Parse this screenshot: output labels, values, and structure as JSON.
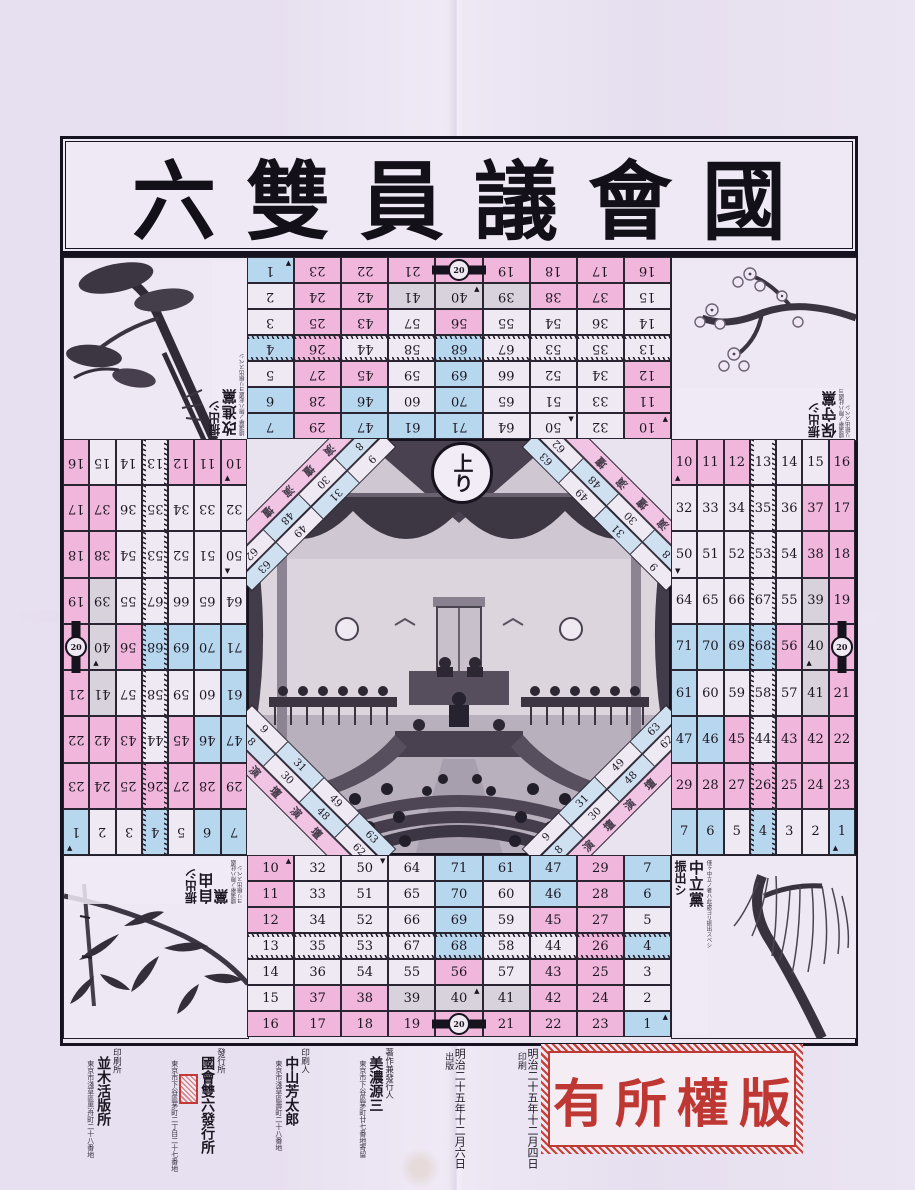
{
  "title": "國會議員雙六",
  "goal_label": "上り",
  "stamp_text": "版權所有",
  "track": {
    "barrier_value": "20",
    "diag_label": "演壇",
    "diag_outer": [
      "9",
      "31",
      "49",
      "63"
    ],
    "diag_inner": [
      "8",
      "30",
      "48",
      "62"
    ],
    "zig_row_index": 3,
    "rows": [
      [
        {
          "n": 16,
          "c": "p"
        },
        {
          "n": 17,
          "c": "p"
        },
        {
          "n": 18,
          "c": "p"
        },
        {
          "n": 19,
          "c": "p"
        },
        {
          "n": 20,
          "c": "p",
          "bar": true
        },
        {
          "n": 21,
          "c": "p"
        },
        {
          "n": 22,
          "c": "p"
        },
        {
          "n": 23,
          "c": "p"
        },
        {
          "n": 1,
          "c": "b",
          "m": "▲"
        }
      ],
      [
        {
          "n": 15,
          "c": "w"
        },
        {
          "n": 37,
          "c": "p"
        },
        {
          "n": 38,
          "c": "p"
        },
        {
          "n": 39,
          "c": "g"
        },
        {
          "n": 40,
          "c": "g",
          "m": "▲"
        },
        {
          "n": 41,
          "c": "g"
        },
        {
          "n": 42,
          "c": "p"
        },
        {
          "n": 24,
          "c": "p"
        },
        {
          "n": 2,
          "c": "w"
        }
      ],
      [
        {
          "n": 14,
          "c": "w"
        },
        {
          "n": 36,
          "c": "w"
        },
        {
          "n": 54,
          "c": "w"
        },
        {
          "n": 55,
          "c": "w"
        },
        {
          "n": 56,
          "c": "p"
        },
        {
          "n": 57,
          "c": "w"
        },
        {
          "n": 43,
          "c": "p"
        },
        {
          "n": 25,
          "c": "p"
        },
        {
          "n": 3,
          "c": "w"
        }
      ],
      [
        {
          "n": 13,
          "c": "w"
        },
        {
          "n": 35,
          "c": "w"
        },
        {
          "n": 53,
          "c": "w"
        },
        {
          "n": 67,
          "c": "w"
        },
        {
          "n": 68,
          "c": "b"
        },
        {
          "n": 58,
          "c": "w"
        },
        {
          "n": 44,
          "c": "w"
        },
        {
          "n": 26,
          "c": "p"
        },
        {
          "n": 4,
          "c": "b"
        }
      ],
      [
        {
          "n": 12,
          "c": "p"
        },
        {
          "n": 34,
          "c": "w"
        },
        {
          "n": 52,
          "c": "w"
        },
        {
          "n": 66,
          "c": "w"
        },
        {
          "n": 69,
          "c": "b"
        },
        {
          "n": 59,
          "c": "w"
        },
        {
          "n": 45,
          "c": "p"
        },
        {
          "n": 27,
          "c": "p"
        },
        {
          "n": 5,
          "c": "w"
        }
      ],
      [
        {
          "n": 11,
          "c": "p"
        },
        {
          "n": 33,
          "c": "w"
        },
        {
          "n": 51,
          "c": "w"
        },
        {
          "n": 65,
          "c": "w"
        },
        {
          "n": 70,
          "c": "b"
        },
        {
          "n": 60,
          "c": "w"
        },
        {
          "n": 46,
          "c": "b"
        },
        {
          "n": 28,
          "c": "p"
        },
        {
          "n": 6,
          "c": "b"
        }
      ],
      [
        {
          "n": 10,
          "c": "p",
          "m": "▲"
        },
        {
          "n": 32,
          "c": "w"
        },
        {
          "n": 50,
          "c": "w",
          "m": "▼"
        },
        {
          "n": 64,
          "c": "w"
        },
        {
          "n": 71,
          "c": "b"
        },
        {
          "n": 61,
          "c": "b"
        },
        {
          "n": 47,
          "c": "b"
        },
        {
          "n": 29,
          "c": "p"
        },
        {
          "n": 7,
          "c": "b"
        }
      ]
    ]
  },
  "corners": {
    "top_left": {
      "party": "改進黨",
      "start": "振出シ",
      "note": "總選擧ノ際ハ此處ヨリ振出スベシ",
      "illustration": "pine"
    },
    "top_right": {
      "party": "保守黨",
      "start": "振出シ",
      "note": "總選擧ノ際ハ此處ヨリ振出スベシ",
      "illustration": "cherry-blossom"
    },
    "bottom_left": {
      "party": "自由黨",
      "start": "振出シ",
      "note": "總選擧ノ際ハ此處ヨリ振出スベシ",
      "illustration": "bamboo"
    },
    "bottom_right": {
      "party": "中立黨",
      "start": "振出シ",
      "note": "僅ヶ中立ノ者ハ此處ヨリ振出スベシ",
      "illustration": "willow"
    }
  },
  "colors": {
    "p": "#f0b6dc",
    "b": "#b7d7ee",
    "w": "#eee9f3",
    "g": "#d8d2dc",
    "bar": "#17131e",
    "stamp_red": "#bf3733"
  },
  "colophon": [
    {
      "date": "明治二十五年十二月四日",
      "side": "印刷"
    },
    {
      "date": "明治二十五年十二月六日",
      "side": "出版"
    },
    {
      "head": "著作兼發行人",
      "name": "美濃源三",
      "addr": "東京市下谷區茅町廿七番地寄留"
    },
    {
      "head": "印刷人",
      "name": "中山芳太郎",
      "addr": "東京市淺草區壽町二十八番地"
    },
    {
      "head": "發行所",
      "name": "國會雙六發行所",
      "addr": "東京市下谷區茅町二丁目二十七番地",
      "seal": true
    },
    {
      "head": "印刷所",
      "name": "並木活版所",
      "addr": "東京市淺草區黒舟町二十八番地"
    }
  ]
}
